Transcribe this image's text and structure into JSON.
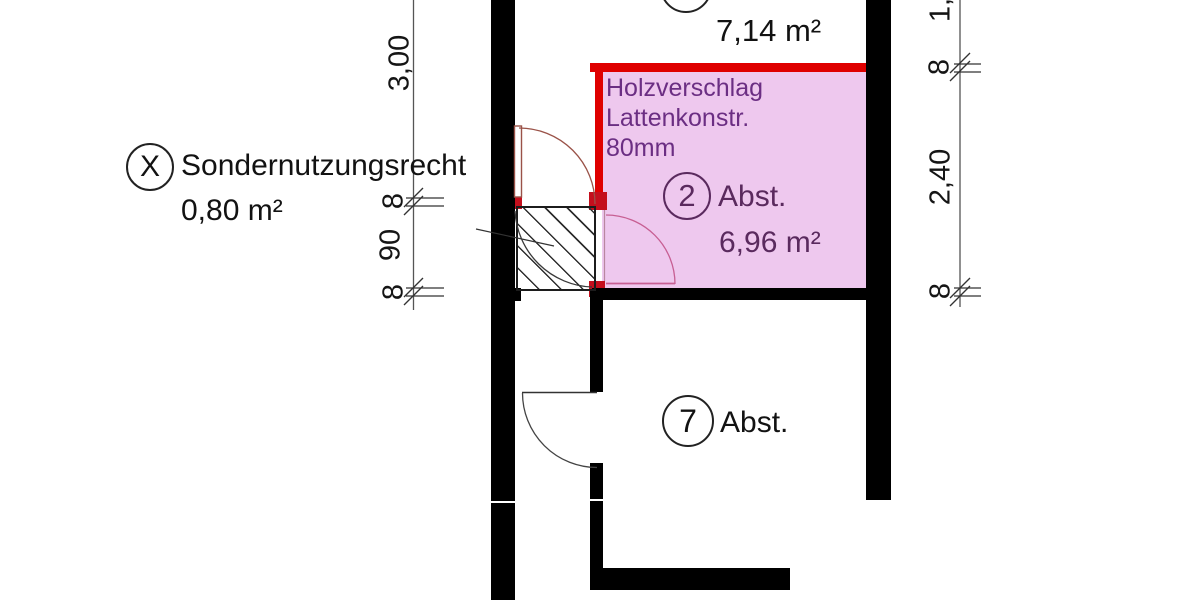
{
  "plan": {
    "room_top": {
      "area": "7,14 m²"
    },
    "room_2": {
      "number": "2",
      "label": "Abst.",
      "area": "6,96 m²"
    },
    "room_7": {
      "number": "7",
      "label": "Abst."
    },
    "special_use": {
      "symbol": "X",
      "name": "Sondernutzungsrecht",
      "area": "0,80 m²"
    },
    "partition_note": {
      "line1": "Holzverschlag",
      "line2": "Lattenkonstr.",
      "line3": "80mm"
    },
    "dims_left": {
      "span": "3,00",
      "wall_top": "8",
      "opening": "90",
      "wall_bottom": "8"
    },
    "dims_right": {
      "partial": "1,",
      "wall_top": "8",
      "span": "2,40",
      "wall_bottom": "8"
    },
    "colors": {
      "wall_black": "#000000",
      "partition_red": "#df0000",
      "partition_post_red": "#c40f1d",
      "room_fill_pink": "#eec8ee",
      "note_purple": "#6b2e83",
      "room2_text_purple": "#5a2a5e",
      "door_arc_brown": "#9a5248",
      "door_arc_pink": "#c75f93"
    }
  }
}
